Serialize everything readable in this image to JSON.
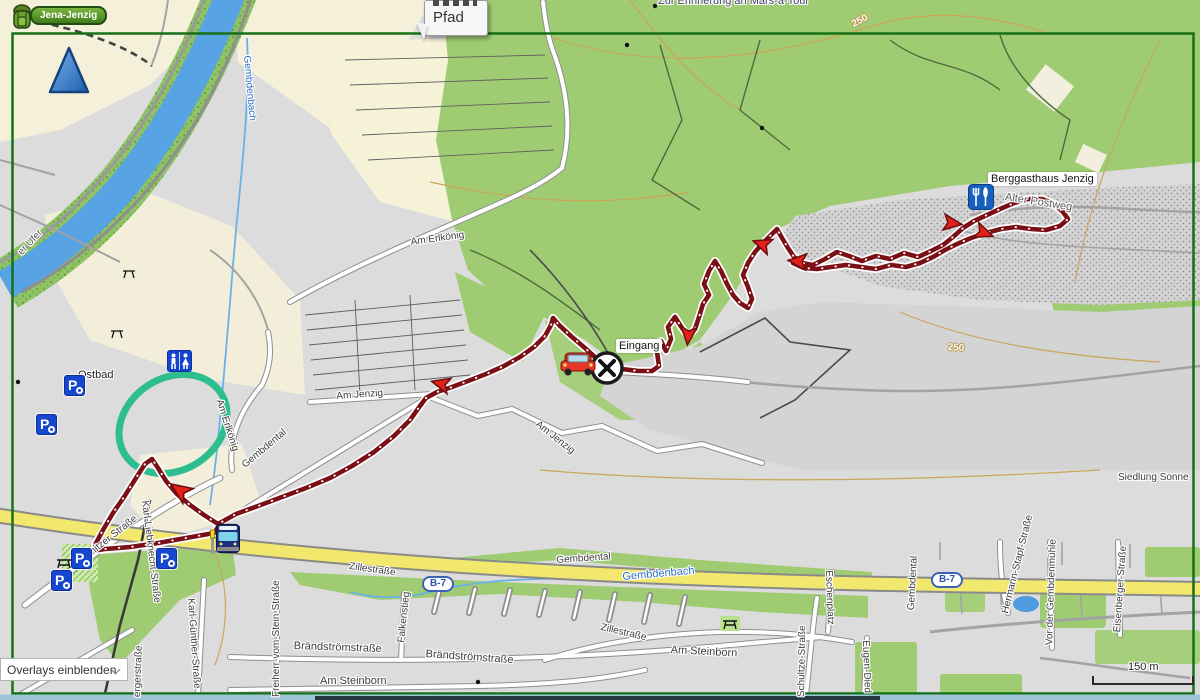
{
  "overlay": {
    "route_name": "Jena-Jenzig",
    "tooltip_line": "Pfad",
    "overlays_dropdown": "Overlays einblenden",
    "scale_label": "150 m"
  },
  "badges": {
    "b7_left": "B-7",
    "b7_right": "B-7"
  },
  "poi": {
    "berggasthaus": "Berggasthaus Jenzig",
    "eingang": "Eingang",
    "ostbad": "Ostbad",
    "siedlung": "Siedlung Sonne"
  },
  "water": {
    "gembdenbach_vertical": "Gembdenbach",
    "gembdenbach_valley": "Gembdenbach",
    "ufer": "er Ufer"
  },
  "contours": {
    "c1": "250",
    "c2": "250"
  },
  "icons": {
    "parking_letter": "P"
  },
  "streets": {
    "erinnerung": "Zur Erinnerung an Mars-a-Tour",
    "am_erlkoenig_1": "Am Erlkönig",
    "am_erlkoenig_2": "Am Erlkönig",
    "am_jenzig_1": "Am Jenzig",
    "am_jenzig_2": "Am Jenzig",
    "alter_postweg": "Alter Postweg",
    "kunitzer": "Kunitzer Straße",
    "karl_liebknecht": "Karl-Liebknecht-Straße",
    "karl_guenther": "Karl-Günther-Straße",
    "erger": "ergerstraße",
    "freiherr": "Freiherr-vom-Stein-Straße",
    "falkenstieg": "Falkenstieg",
    "braendstroem_1": "Brändströmstraße",
    "braendstroem_2": "Brändströmstraße",
    "am_steinborn_1": "Am Steinborn",
    "am_steinborn_2": "Am Steinborn",
    "zillestrasse_1": "Zillestraße",
    "zillestrasse_2": "Zillestraße",
    "gembdental_1": "Gembdental",
    "gembdental_2": "Gembdental",
    "gembdental_3": "Gembdental",
    "hermann_stapf": "Hermann-Stapf-Straße",
    "vor_der_gembdenmuehle": "Vor der Gembdenmühle",
    "eisenberger": "Eisenberger Straße",
    "schultze": "Schultze-Straße",
    "eschenplatz": "Eschenplatz",
    "eugen": "Eugen-Died"
  },
  "colors": {
    "route": "#7a1016",
    "forest": "#9fcc73",
    "road_yellow": "#f2e86d",
    "border_green": "#167016",
    "parking_blue": "#1746cf",
    "oval_green": "#2ebd8e",
    "river_blue": "#58a3e4"
  }
}
